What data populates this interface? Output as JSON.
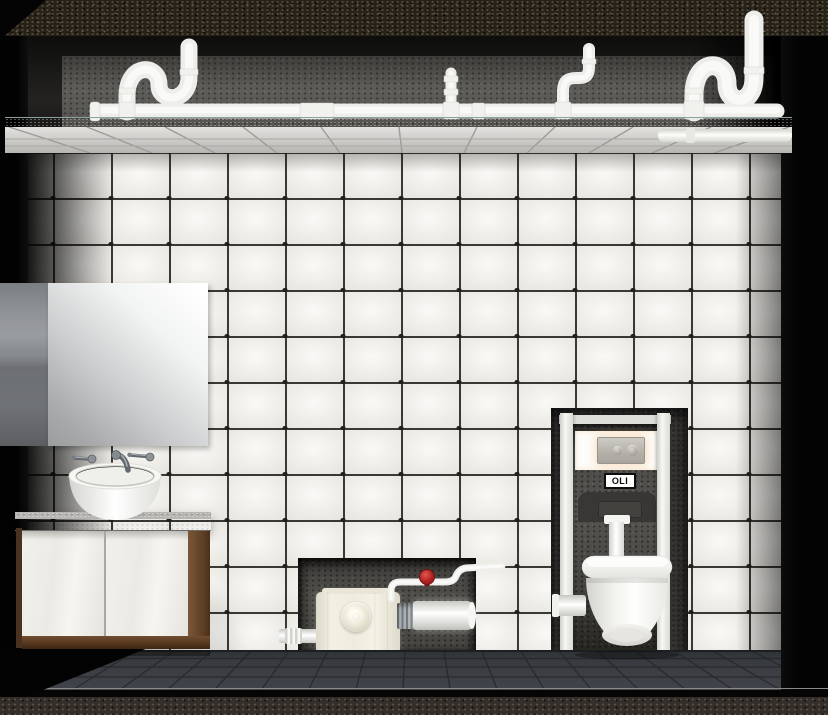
{
  "scene": {
    "type": "3d-bathroom-installation-render",
    "labels": {
      "flush_plate_brand": "OLI"
    },
    "objects": [
      "ceiling-drain-pipes",
      "suspended-ceiling",
      "tiled-wall",
      "mirror",
      "wall-faucet",
      "vessel-basin",
      "vanity-cabinet",
      "macerator-pump",
      "shutoff-valve",
      "discharge-pipe",
      "concealed-cistern-frame",
      "flush-plate",
      "wall-hung-toilet",
      "tiled-floor"
    ],
    "colors": {
      "wall_tile": "#f3f1eb",
      "tile_grout": "#3a3835",
      "floor_tile": "#3b3e42",
      "ceiling_panel": "#d2d1ce",
      "pipe_white": "#f2f2ef",
      "pump_body": "#efecdd",
      "valve_red": "#c3272b",
      "wood": "#6e4c2f",
      "counter_concrete": "#a3a2a0",
      "niche_concrete": "#4a4845",
      "background_black": "#060606"
    }
  }
}
